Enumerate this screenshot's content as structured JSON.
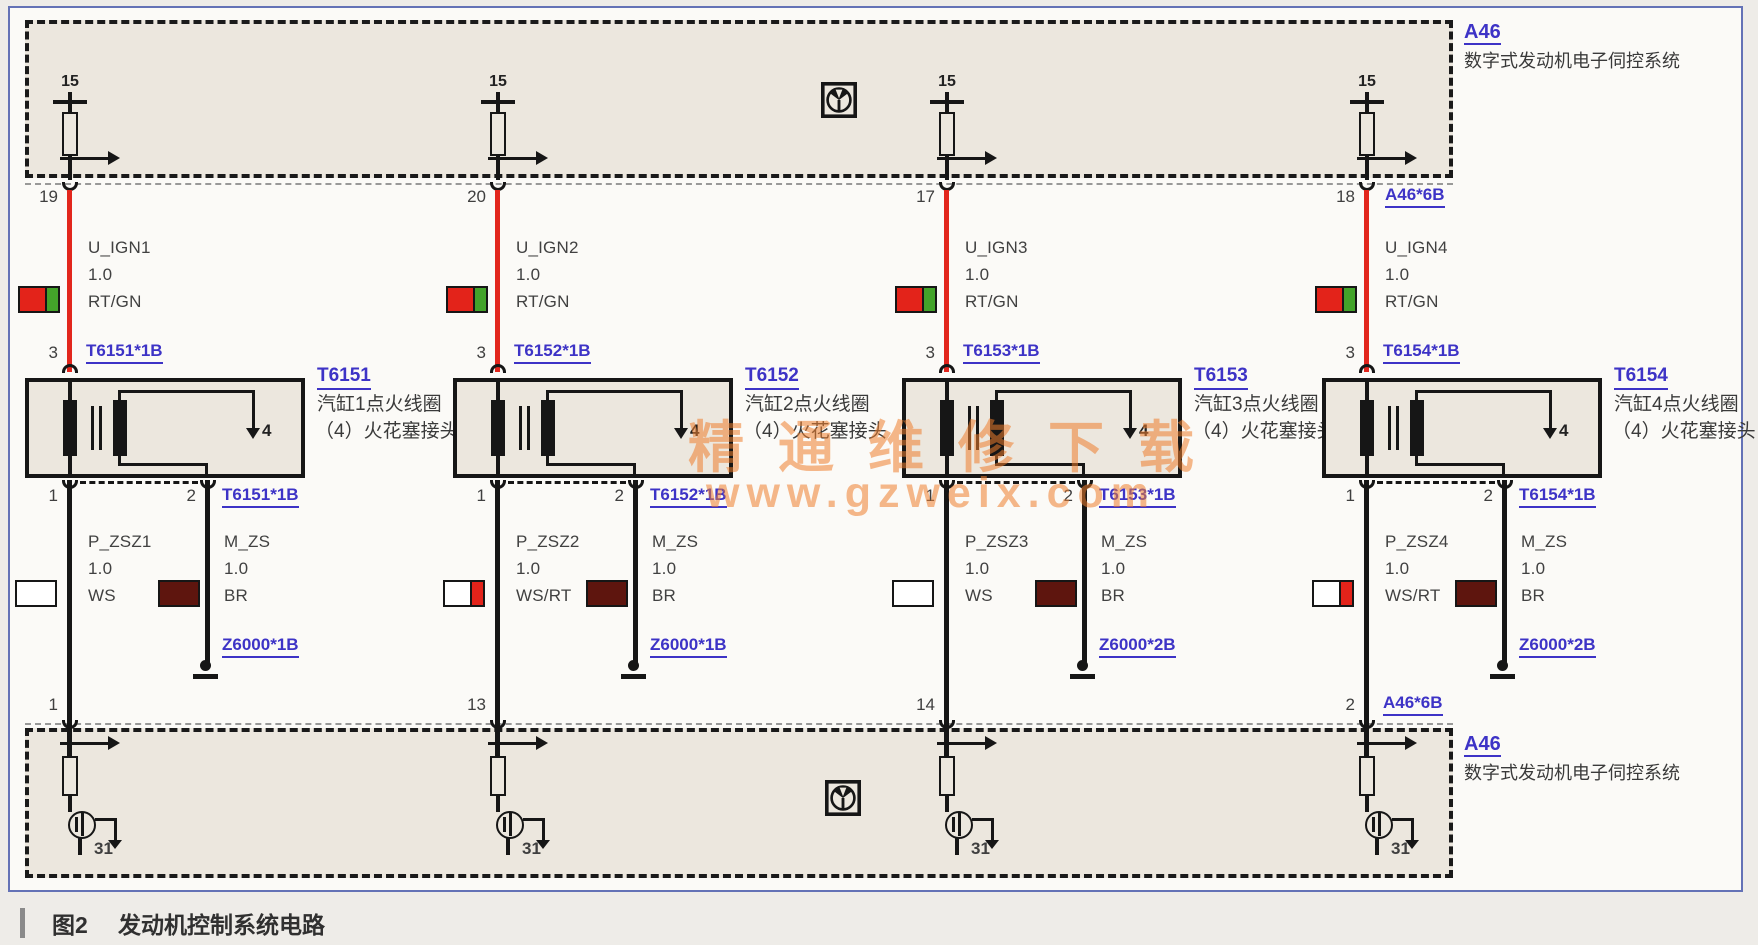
{
  "caption": {
    "figure": "图2",
    "title": "发动机控制系统电路"
  },
  "watermark": {
    "line1": "精通维修下载",
    "line2": "www.gzweix.com"
  },
  "top_module": {
    "id": "A46",
    "name": "数字式发动机电子伺控系统",
    "supply_terminal": "15"
  },
  "bottom_module": {
    "id": "A46",
    "name": "数字式发动机电子伺控系统",
    "ground_terminal": "31"
  },
  "colors": {
    "wire_red": "#e2261c",
    "wire_black": "#161616",
    "label_blue": "#3d33c6",
    "box_fill": "#ece7de",
    "swatch_red": "#e3231a",
    "swatch_green": "#43a32a",
    "swatch_brown": "#5e150e",
    "swatch_white": "#ffffff"
  },
  "columns": [
    {
      "top_pin": "19",
      "top_pin_label": "",
      "ign_signal": "U_IGN1",
      "ign_gauge": "1.0",
      "ign_color": "RT/GN",
      "ign_swatch": [
        "#e3231a",
        "#43a32a"
      ],
      "coil_top_pin": "3",
      "coil_top_conn": "T6151*1B",
      "coil_id": "T6151",
      "coil_desc1": "汽缸1点火线圈",
      "coil_desc2": "（4）火花塞接头",
      "spark_terminal": "4",
      "out_pin_p": "1",
      "out_pin_m": "2",
      "coil_bottom_conn": "T6151*1B",
      "p_signal": "P_ZSZ1",
      "p_gauge": "1.0",
      "p_color": "WS",
      "p_swatch": [
        "#ffffff"
      ],
      "m_signal": "M_ZS",
      "m_gauge": "1.0",
      "m_color": "BR",
      "m_swatch": [
        "#5e150e"
      ],
      "ground_conn": "Z6000*1B",
      "bottom_pin": "1",
      "bottom_pin_label": ""
    },
    {
      "top_pin": "20",
      "top_pin_label": "",
      "ign_signal": "U_IGN2",
      "ign_gauge": "1.0",
      "ign_color": "RT/GN",
      "ign_swatch": [
        "#e3231a",
        "#43a32a"
      ],
      "coil_top_pin": "3",
      "coil_top_conn": "T6152*1B",
      "coil_id": "T6152",
      "coil_desc1": "汽缸2点火线圈",
      "coil_desc2": "（4）火花塞接头",
      "spark_terminal": "4",
      "out_pin_p": "1",
      "out_pin_m": "2",
      "coil_bottom_conn": "T6152*1B",
      "p_signal": "P_ZSZ2",
      "p_gauge": "1.0",
      "p_color": "WS/RT",
      "p_swatch": [
        "#ffffff",
        "#e3231a"
      ],
      "m_signal": "M_ZS",
      "m_gauge": "1.0",
      "m_color": "BR",
      "m_swatch": [
        "#5e150e"
      ],
      "ground_conn": "Z6000*1B",
      "bottom_pin": "13",
      "bottom_pin_label": ""
    },
    {
      "top_pin": "17",
      "top_pin_label": "",
      "ign_signal": "U_IGN3",
      "ign_gauge": "1.0",
      "ign_color": "RT/GN",
      "ign_swatch": [
        "#e3231a",
        "#43a32a"
      ],
      "coil_top_pin": "3",
      "coil_top_conn": "T6153*1B",
      "coil_id": "T6153",
      "coil_desc1": "汽缸3点火线圈",
      "coil_desc2": "（4）火花塞接头",
      "spark_terminal": "4",
      "out_pin_p": "1",
      "out_pin_m": "2",
      "coil_bottom_conn": "T6153*1B",
      "p_signal": "P_ZSZ3",
      "p_gauge": "1.0",
      "p_color": "WS",
      "p_swatch": [
        "#ffffff"
      ],
      "m_signal": "M_ZS",
      "m_gauge": "1.0",
      "m_color": "BR",
      "m_swatch": [
        "#5e150e"
      ],
      "ground_conn": "Z6000*2B",
      "bottom_pin": "14",
      "bottom_pin_label": ""
    },
    {
      "top_pin": "18",
      "top_pin_label": "A46*6B",
      "ign_signal": "U_IGN4",
      "ign_gauge": "1.0",
      "ign_color": "RT/GN",
      "ign_swatch": [
        "#e3231a",
        "#43a32a"
      ],
      "coil_top_pin": "3",
      "coil_top_conn": "T6154*1B",
      "coil_id": "T6154",
      "coil_desc1": "汽缸4点火线圈",
      "coil_desc2": "（4）火花塞接头",
      "spark_terminal": "4",
      "out_pin_p": "1",
      "out_pin_m": "2",
      "coil_bottom_conn": "T6154*1B",
      "p_signal": "P_ZSZ4",
      "p_gauge": "1.0",
      "p_color": "WS/RT",
      "p_swatch": [
        "#ffffff",
        "#e3231a"
      ],
      "m_signal": "M_ZS",
      "m_gauge": "1.0",
      "m_color": "BR",
      "m_swatch": [
        "#5e150e"
      ],
      "ground_conn": "Z6000*2B",
      "bottom_pin": "2",
      "bottom_pin_label": "A46*6B"
    }
  ]
}
